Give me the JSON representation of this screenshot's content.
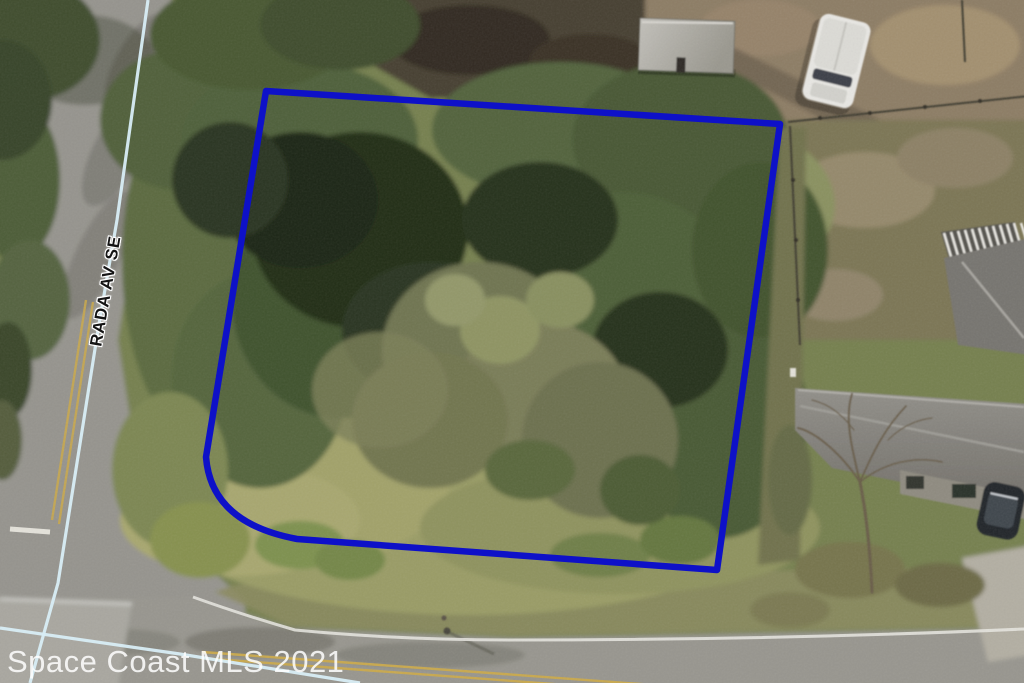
{
  "map": {
    "street_label": "RADA AV SE",
    "watermark": "Space Coast MLS 2021",
    "overlay": {
      "boundary_color": "#0e11c8",
      "boundary_path": "M 266,91 L 780,124 L 717,570 L 297,539 Q 211,523 206,457 Z",
      "centerline_color": "#d8edf6",
      "rada_centerline_points": "148,0 117,220 98,330 58,583 30,683",
      "cross_centerline_points": "0,628 180,654 360,683"
    }
  }
}
